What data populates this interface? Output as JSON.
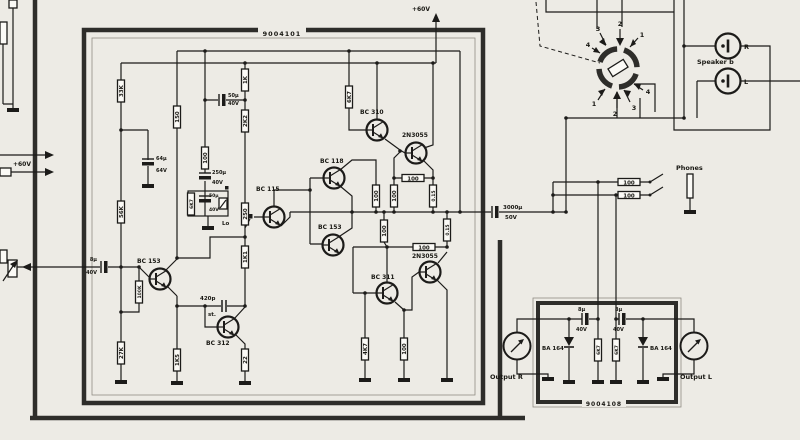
{
  "boards": {
    "main": "9004101",
    "output": "9004108"
  },
  "power": {
    "rail_top": "+60V",
    "input_left": "+60V"
  },
  "transistors": {
    "q1": "BC 310",
    "q2": "2N3055",
    "q3": "BC 118",
    "q4": "BC 115",
    "q5": "BC 153",
    "q6": "BC 153",
    "q7": "BC 311",
    "q8": "2N3055",
    "q9": "BC 312"
  },
  "resistors": {
    "r1": "33K",
    "r2": "150",
    "r3": "1K",
    "r4": "2K2",
    "r5": "6K7",
    "r6": "100",
    "r7": "56K",
    "r8": "250",
    "r9": "1K1",
    "r10": "100K",
    "r11": "27K",
    "r12": "1K5",
    "r13": "22",
    "r14": "6K7",
    "r15": "100",
    "r16": "100",
    "r17": "0.15",
    "r18": "100",
    "r19": "0.15",
    "r20": "4K7",
    "r21": "100",
    "r22": "100",
    "r23": "100",
    "r24": "100",
    "r25": "100",
    "r26": "6K7",
    "r27": "6K7"
  },
  "capacitors": {
    "c1": {
      "v": "50μ",
      "u": "40V"
    },
    "c2": {
      "v": "64μ",
      "u": "64V"
    },
    "c3": {
      "v": "250μ",
      "u": "40V"
    },
    "c4": {
      "v": "50μ",
      "u": "40V"
    },
    "c5": {
      "v": "420p",
      "u": "st."
    },
    "c6": {
      "v": "3000μ",
      "u": "50V"
    },
    "c7": {
      "v": "8μ",
      "u": "40V"
    },
    "c8": {
      "v": "8μ",
      "u": "40V"
    },
    "c9": {
      "v": "8μ",
      "u": "40V"
    }
  },
  "diodes": {
    "d1": "BA 164",
    "d2": "BA 164"
  },
  "labels": {
    "speaker_b": "Speaker b",
    "jack_r": "R",
    "jack_l": "L",
    "phones": "Phones",
    "output_r": "Output R",
    "output_l": "Output L",
    "lo": "Lo"
  },
  "switch": {
    "top": [
      "3",
      "2",
      "1",
      "4"
    ],
    "bottom": [
      "1",
      "2",
      "3",
      "4"
    ]
  }
}
